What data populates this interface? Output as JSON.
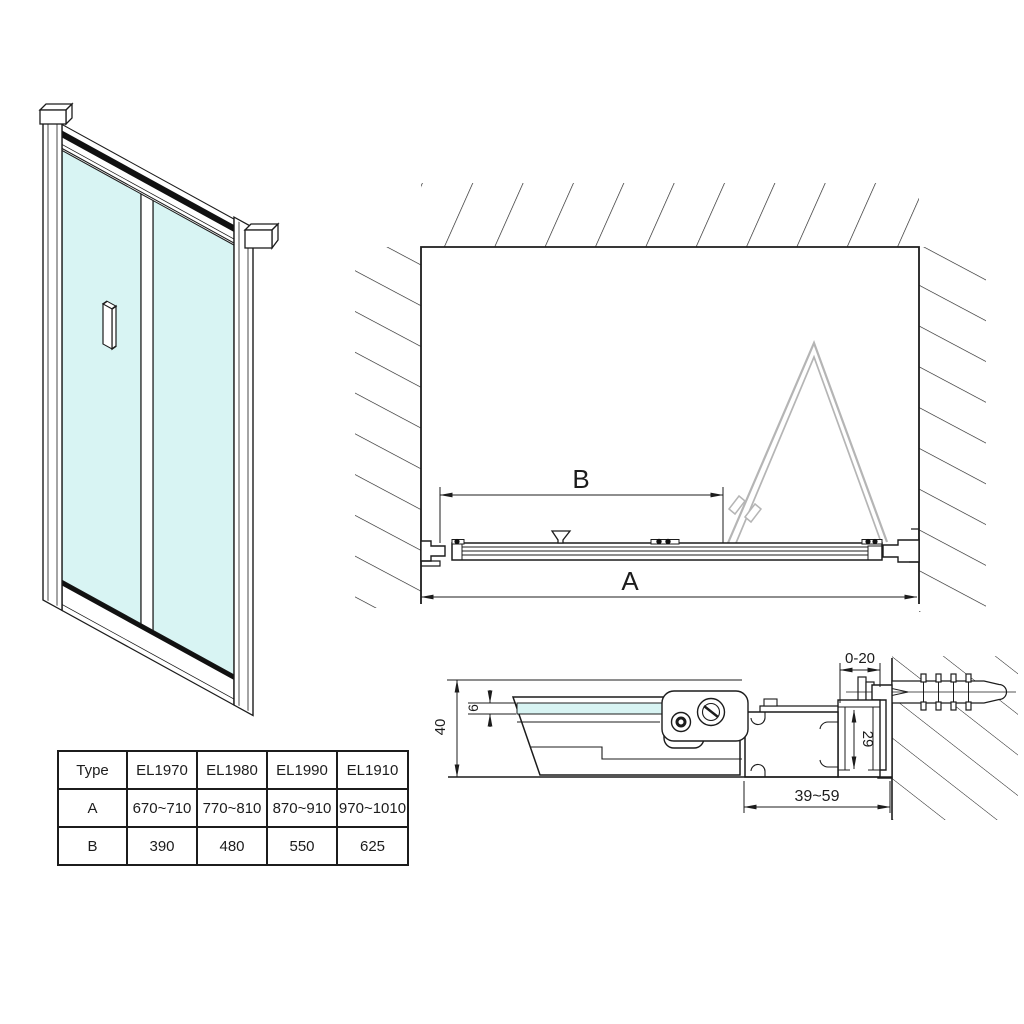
{
  "plan_view": {
    "dim_width_total": "A",
    "dim_width_entry": "B"
  },
  "section_view": {
    "dim_depth": "40",
    "dim_glass_thickness": "6",
    "dim_wall_adjust": "0-20",
    "dim_profile_height": "29",
    "dim_extension_range": "39~59"
  },
  "spec_table": {
    "columns": [
      "Type",
      "EL1970",
      "EL1980",
      "EL1990",
      "EL1910"
    ],
    "rows": [
      {
        "label": "A",
        "values": [
          "670~710",
          "770~810",
          "870~910",
          "970~1010"
        ]
      },
      {
        "label": "B",
        "values": [
          "390",
          "480",
          "550",
          "625"
        ]
      }
    ]
  },
  "colors": {
    "line": "#1c1c1c",
    "glass": "#d8f4f3",
    "ghost_door": "#b5b5b5"
  }
}
